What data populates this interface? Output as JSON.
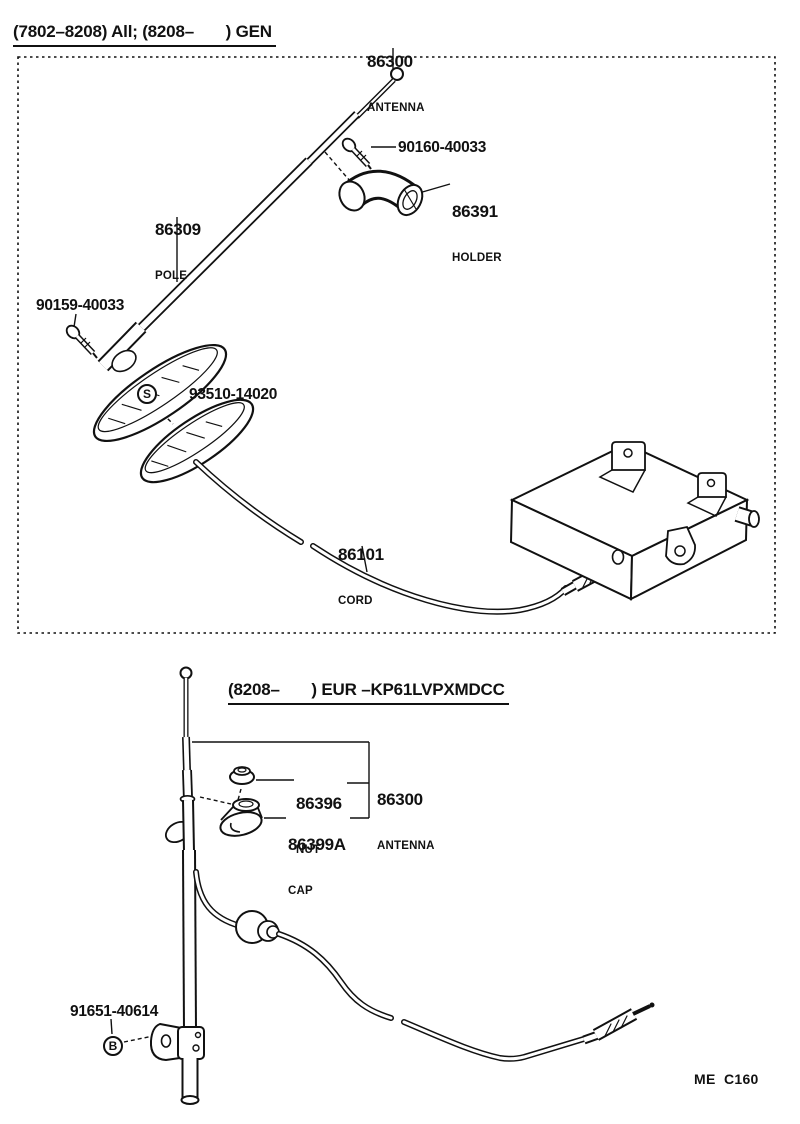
{
  "page": {
    "bg_color": "#ffffff",
    "ink_color": "#111111",
    "footer_code": "ME  C160"
  },
  "diagram1": {
    "header": "(7802–8208) All; (8208–       ) GEN",
    "antenna": {
      "part_no": "86300",
      "name": "ANTENNA"
    },
    "screw_upper": {
      "part_no": "90160-40033"
    },
    "holder": {
      "part_no": "86391",
      "name": "HOLDER"
    },
    "pole": {
      "part_no": "86309",
      "name": "POLE"
    },
    "screw_lower": {
      "part_no": "90159-40033"
    },
    "pad": {
      "marker": "S",
      "part_no": "93510-14020"
    },
    "cord": {
      "part_no": "86101",
      "name": "CORD"
    }
  },
  "diagram2": {
    "header": "(8208–       ) EUR –KP61LVPXMDCC",
    "nut": {
      "part_no": "86396",
      "name": "NUT"
    },
    "antenna": {
      "part_no": "86300",
      "name": "ANTENNA"
    },
    "cap": {
      "part_no": "86399A",
      "name": "CAP"
    },
    "bolt": {
      "marker": "B",
      "part_no": "91651-40614"
    }
  }
}
